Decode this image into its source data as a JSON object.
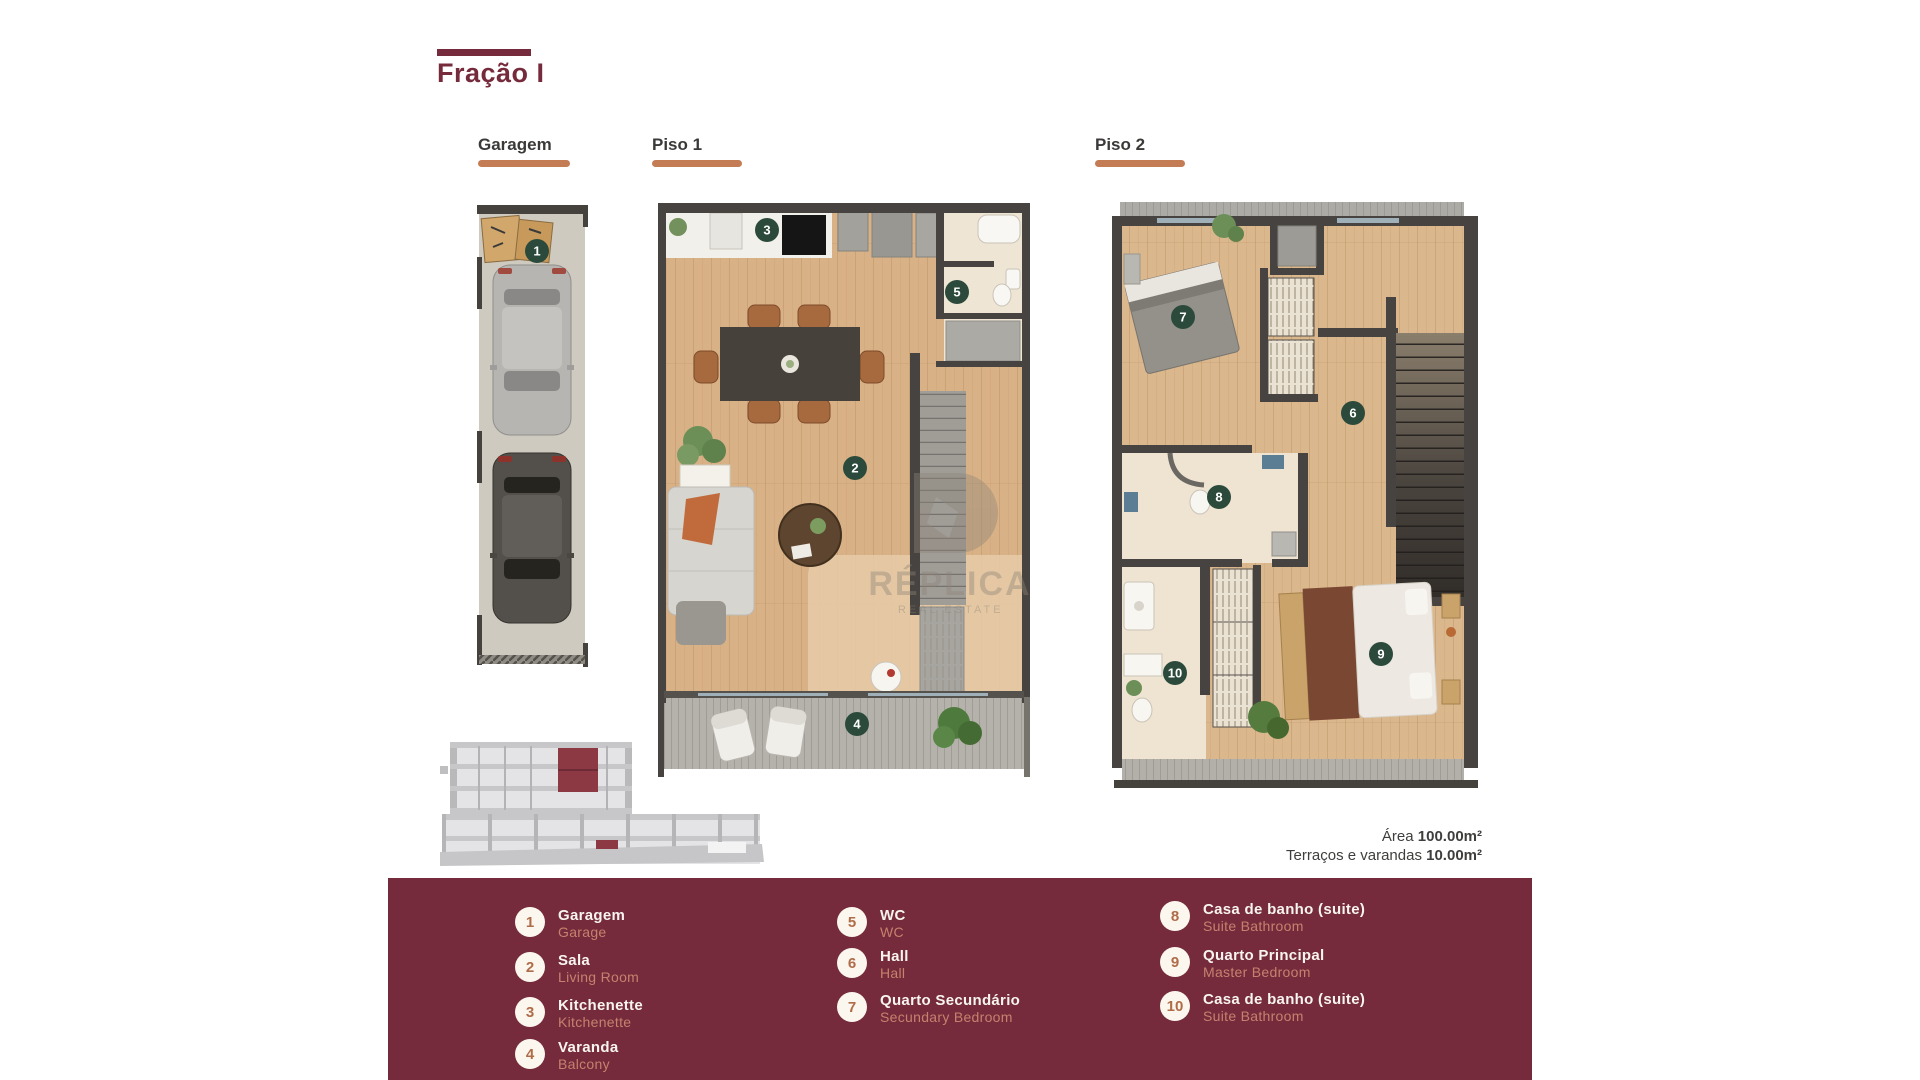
{
  "title": "Fração I",
  "plans": {
    "garagem": {
      "label": "Garagem",
      "badges": {
        "b1": "1"
      }
    },
    "piso1": {
      "label": "Piso 1",
      "badges": {
        "b2": "2",
        "b3": "3",
        "b4": "4",
        "b5": "5"
      }
    },
    "piso2": {
      "label": "Piso 2",
      "badges": {
        "b6": "6",
        "b7": "7",
        "b8": "8",
        "b9": "9",
        "b10": "10"
      }
    }
  },
  "areas": {
    "area_label": "Área",
    "area_value": "100.00m²",
    "terrace_label": "Terraços e varandas",
    "terrace_value": "10.00m²"
  },
  "watermark": {
    "name": "RÉPLICA",
    "tagline": "REAL ESTATE"
  },
  "legend": {
    "items": [
      {
        "num": "1",
        "pt": "Garagem",
        "en": "Garage"
      },
      {
        "num": "2",
        "pt": "Sala",
        "en": "Living Room"
      },
      {
        "num": "3",
        "pt": "Kitchenette",
        "en": "Kitchenette"
      },
      {
        "num": "4",
        "pt": "Varanda",
        "en": "Balcony"
      },
      {
        "num": "5",
        "pt": "WC",
        "en": "WC"
      },
      {
        "num": "6",
        "pt": "Hall",
        "en": "Hall"
      },
      {
        "num": "7",
        "pt": "Quarto Secundário",
        "en": "Secundary Bedroom"
      },
      {
        "num": "8",
        "pt": "Casa de banho (suite)",
        "en": "Suite Bathroom"
      },
      {
        "num": "9",
        "pt": "Quarto Principal",
        "en": "Master Bedroom"
      },
      {
        "num": "10",
        "pt": "Casa de banho (suite)",
        "en": "Suite Bathroom"
      }
    ]
  },
  "colors": {
    "brand_maroon": "#752B3B",
    "accent_orange": "#C47C55",
    "plan_badge_green": "#2B4A3B",
    "legend_circle_fill": "#FBF6EE",
    "legend_number": "#AF6C48",
    "legend_secondary_text": "#C5826E",
    "wall": "#474340",
    "wood_floor": "#D9B186",
    "deck_grey": "#B5B2AB",
    "bathroom_floor": "#EFE4D2",
    "highlight_unit": "#8C3944"
  }
}
